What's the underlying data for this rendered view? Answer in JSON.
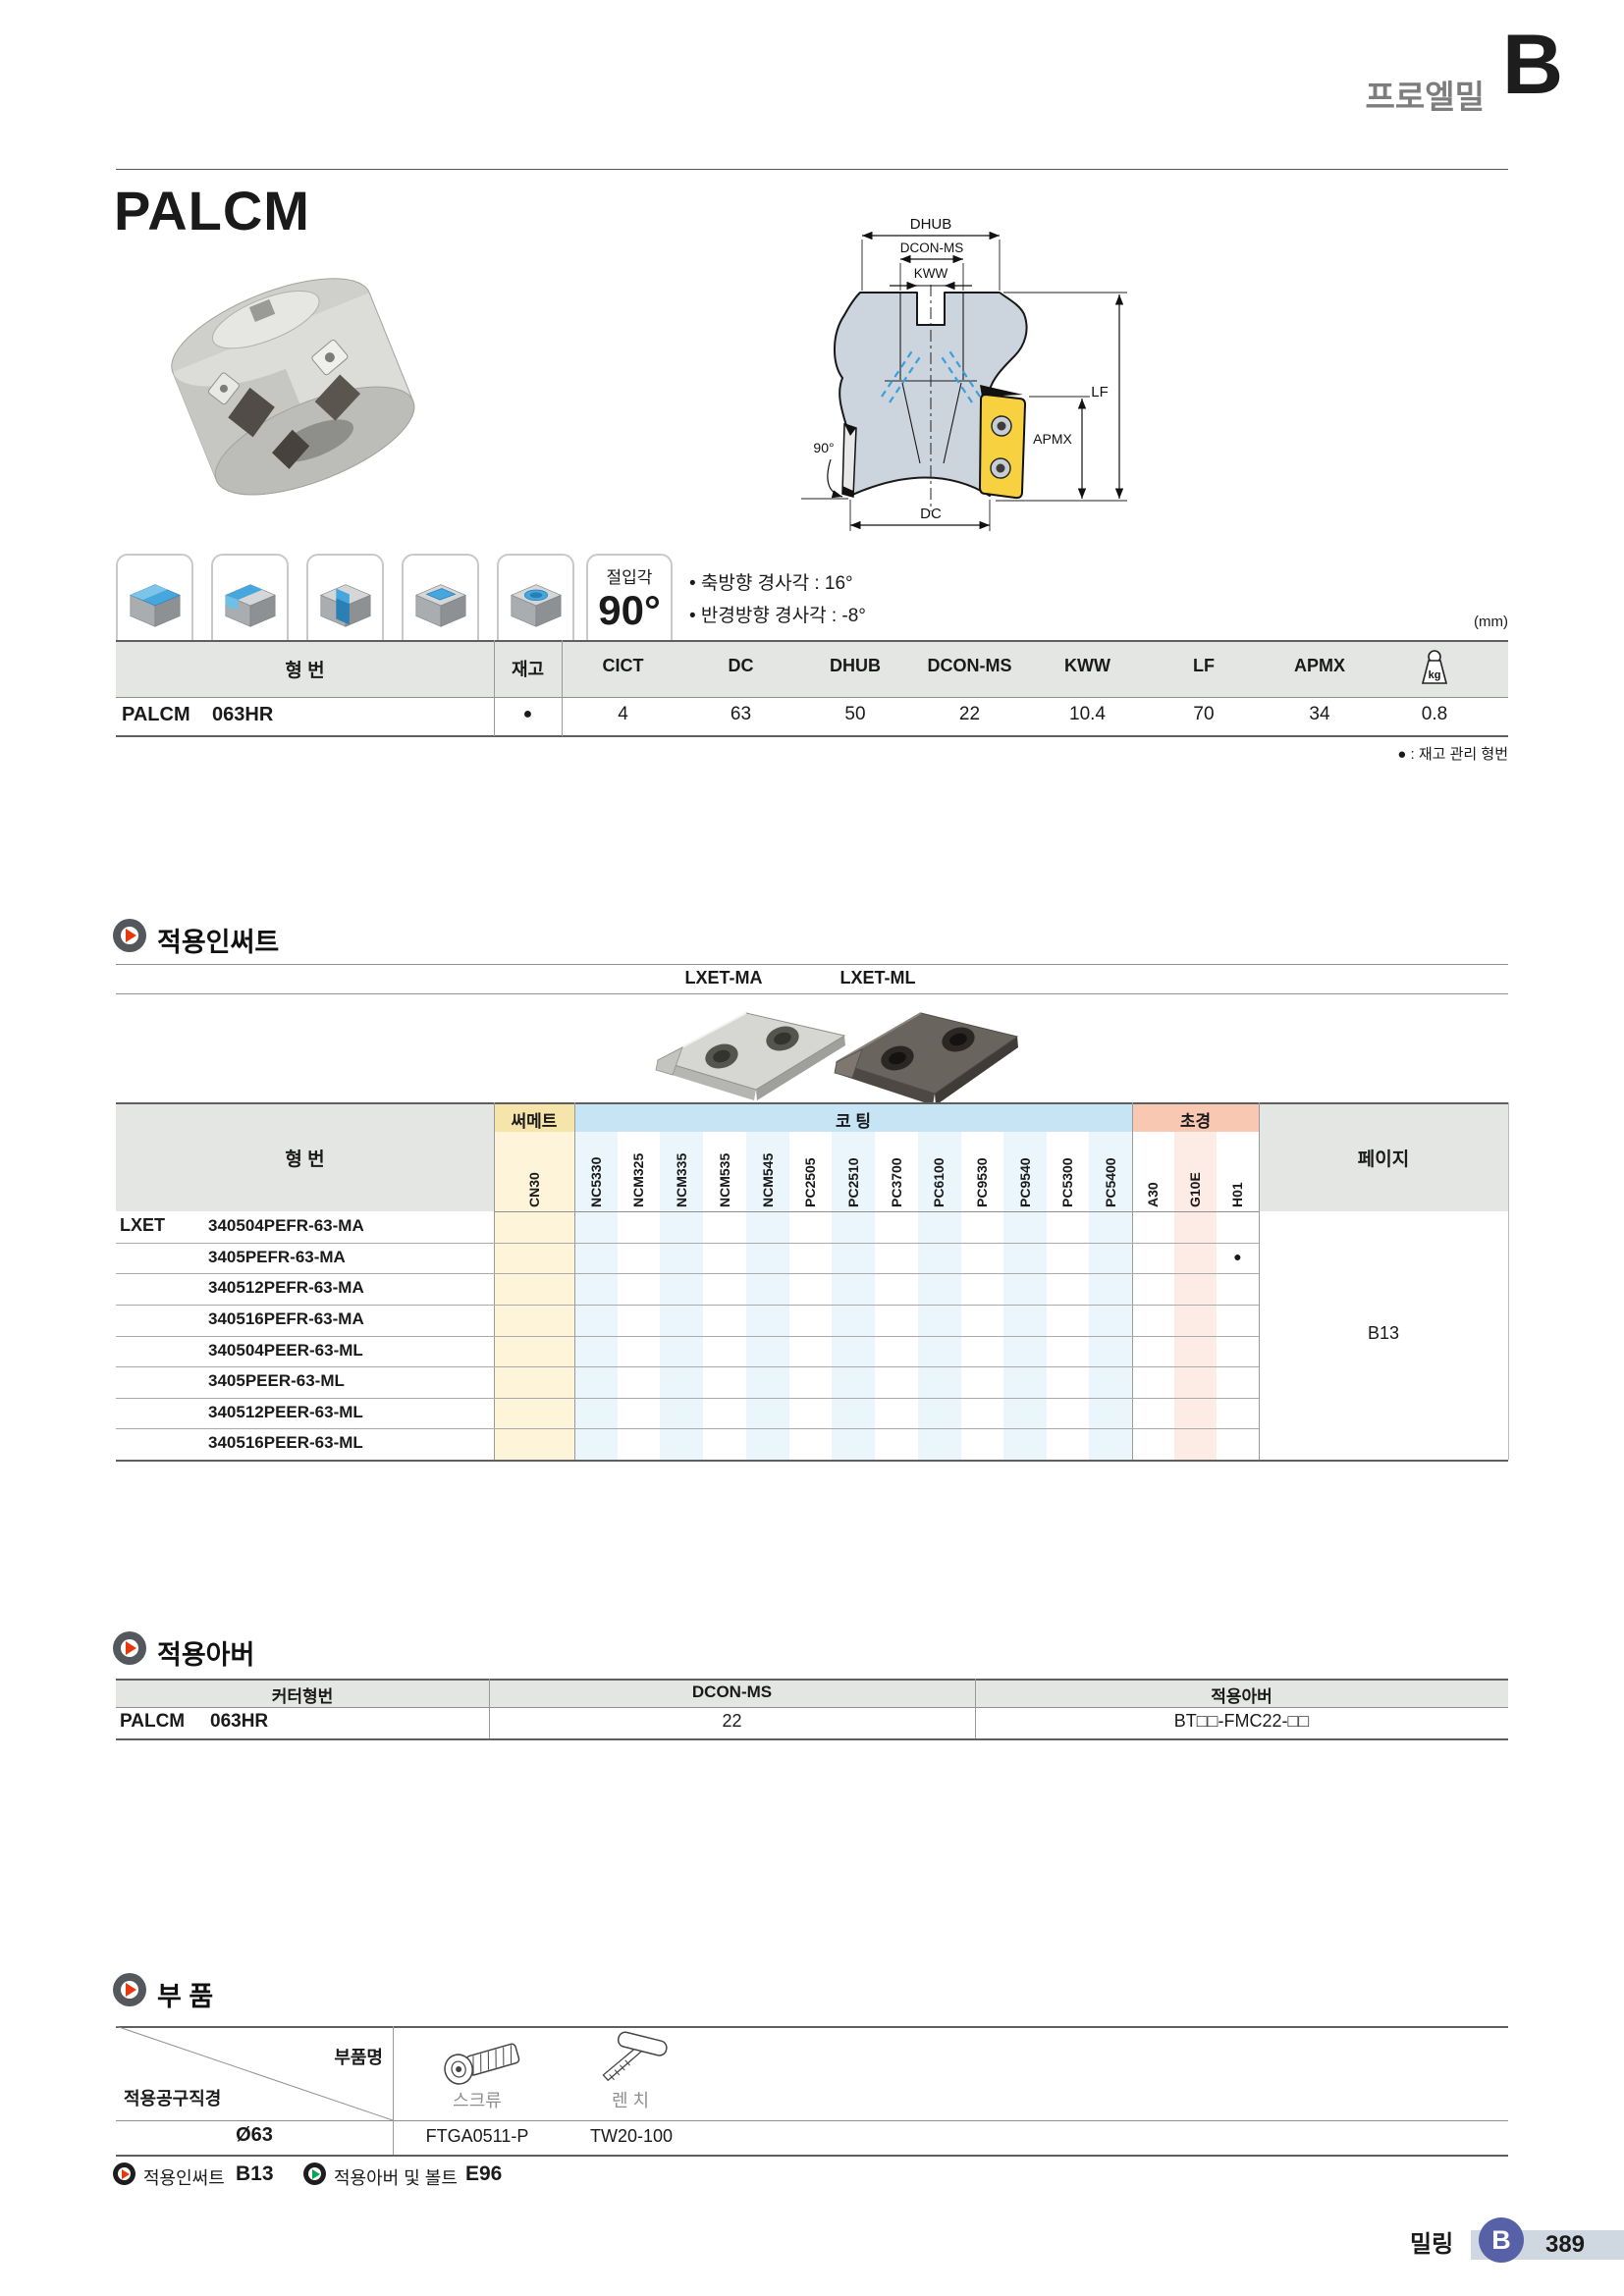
{
  "header": {
    "brand": "프로엘밀",
    "section_letter": "B"
  },
  "title": "PALCM",
  "angle_box": {
    "label": "절입각",
    "value": "90°"
  },
  "notes": [
    "• 축방향 경사각 : 16°",
    "• 반경방향 경사각 : -8°"
  ],
  "unit_note": "(mm)",
  "diagram": {
    "labels": {
      "dhub": "DHUB",
      "dcon": "DCON-MS",
      "kww": "KWW",
      "lf": "LF",
      "apmx": "APMX",
      "dc": "DC",
      "angle": "90°"
    }
  },
  "spec_table": {
    "col_model": "형  번",
    "col_stock": "재고",
    "cols": [
      "CICT",
      "DC",
      "DHUB",
      "DCON-MS",
      "KWW",
      "LF",
      "APMX"
    ],
    "weight_icon_label": "kg",
    "row": {
      "series": "PALCM",
      "model": "063HR",
      "stock": "●",
      "values": [
        "4",
        "63",
        "50",
        "22",
        "10.4",
        "70",
        "34"
      ],
      "weight": "0.8"
    },
    "footnote": "● : 재고 관리 형번"
  },
  "insert_section": {
    "title": "적용인써트",
    "types": [
      "LXET-MA",
      "LXET-ML"
    ],
    "table": {
      "col_model": "형  번",
      "groups": {
        "cermet": "써메트",
        "coating": "코  팅",
        "carbide": "초경",
        "page": "페이지"
      },
      "grades": [
        "CN30",
        "NC5330",
        "NCM325",
        "NCM335",
        "NCM535",
        "NCM545",
        "PC2505",
        "PC2510",
        "PC3700",
        "PC6100",
        "PC9530",
        "PC9540",
        "PC5300",
        "PC5400",
        "A30",
        "G10E",
        "H01"
      ],
      "series": "LXET",
      "rows": [
        {
          "part": "340504PEFR-63-MA",
          "h01": ""
        },
        {
          "part": "3405PEFR-63-MA",
          "h01": "●"
        },
        {
          "part": "340512PEFR-63-MA",
          "h01": ""
        },
        {
          "part": "340516PEFR-63-MA",
          "h01": ""
        },
        {
          "part": "340504PEER-63-ML",
          "h01": ""
        },
        {
          "part": "3405PEER-63-ML",
          "h01": ""
        },
        {
          "part": "340512PEER-63-ML",
          "h01": ""
        },
        {
          "part": "340516PEER-63-ML",
          "h01": ""
        }
      ],
      "page_ref": "B13"
    }
  },
  "arbor_section": {
    "title": "적용아버",
    "headers": [
      "커터형번",
      "DCON-MS",
      "적용아버"
    ],
    "row": {
      "series": "PALCM",
      "model": "063HR",
      "dcon_ms": "22",
      "arbor": "BT□□-FMC22-□□"
    }
  },
  "parts_section": {
    "title": "부 품",
    "col_part": "부품명",
    "col_diameter": "적용공구직경",
    "parts": [
      {
        "name": "스크류",
        "code": "FTGA0511-P"
      },
      {
        "name": "렌  치",
        "code": "TW20-100"
      }
    ],
    "diameter": "Ø63"
  },
  "links": [
    {
      "label": "적용인써트",
      "page": "B13"
    },
    {
      "label": "적용아버 및 볼트",
      "page": "E96"
    }
  ],
  "footer": {
    "category": "밀링",
    "tab": "B",
    "page_number": "389"
  },
  "colors": {
    "accent_red": "#e8380d",
    "accent_green": "#00a650",
    "footer_blue": "#5661a7",
    "cermet_yellow": "#f6e5ab",
    "coating_blue": "#c6e4f4",
    "carbide_pink": "#f8c8b3"
  }
}
